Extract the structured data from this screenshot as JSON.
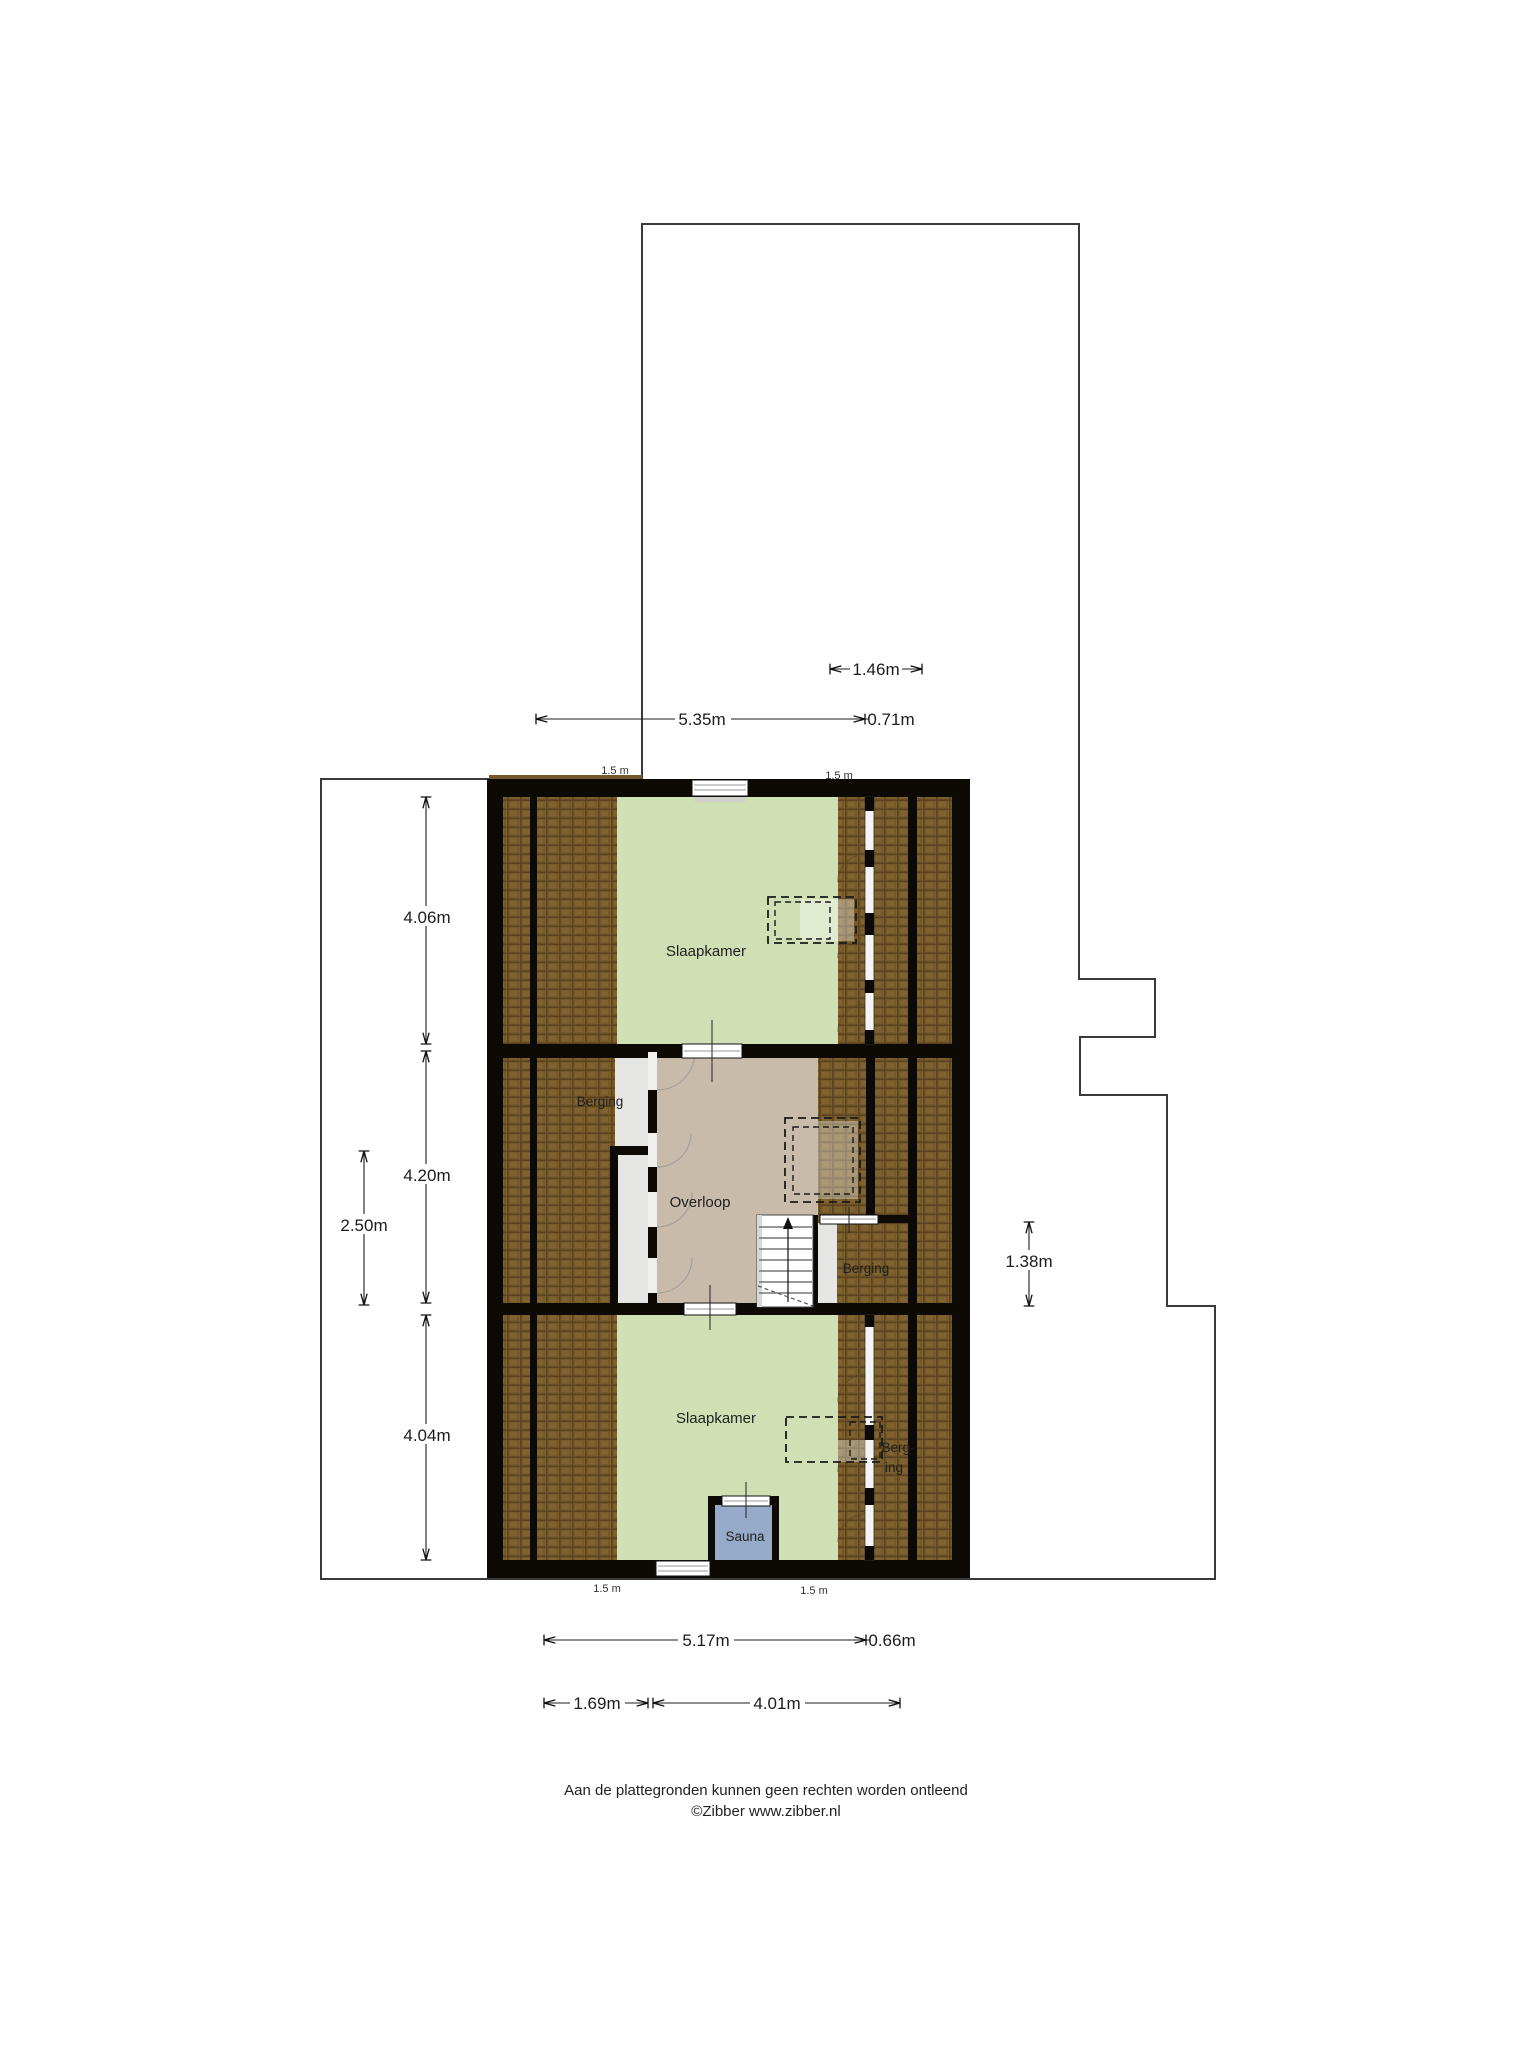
{
  "meta": {
    "type": "floorplan",
    "floor": "attic / second floor"
  },
  "rooms": {
    "slaapkamer_top": {
      "label": "Slaapkamer"
    },
    "berging_left": {
      "label": "Berging"
    },
    "overloop": {
      "label": "Overloop"
    },
    "berging_right": {
      "label": "Berging"
    },
    "slaapkamer_bottom": {
      "label": "Slaapkamer"
    },
    "berging_bottom": {
      "line1": "Berg-",
      "line2": "ing"
    },
    "sauna": {
      "label": "Sauna"
    }
  },
  "dimensions": {
    "top_offset": {
      "label": "1.46m"
    },
    "top_width": {
      "label": "5.35m"
    },
    "top_right": {
      "label": "0.71m"
    },
    "knee_top_left": {
      "label": "1.5 m"
    },
    "knee_top_right": {
      "label": "1.5 m"
    },
    "room_top_height": {
      "label": "4.06m"
    },
    "landing_height": {
      "label": "4.20m"
    },
    "left_width": {
      "label": "2.50m"
    },
    "room_bottom_height": {
      "label": "4.04m"
    },
    "right_height": {
      "label": "1.38m"
    },
    "bottom_width": {
      "label": "5.17m"
    },
    "bottom_right": {
      "label": "0.66m"
    },
    "bottom_seg_left": {
      "label": "1.69m"
    },
    "bottom_seg_mid": {
      "label": "4.01m"
    },
    "knee_bottom_left": {
      "label": "1.5 m"
    },
    "knee_bottom_right": {
      "label": "1.5 m"
    }
  },
  "footer": {
    "disclaimer": "Aan de plattegronden kunnen geen rechten worden ontleend",
    "copyright": "©Zibber www.zibber.nl"
  },
  "colors": {
    "wall": "#0d0a06",
    "roof_tile": "#7d5f2c",
    "roof_tile_dark": "#5a431e",
    "floor_green": "#cfe0b5",
    "floor_tan": "#c9bba9",
    "floor_gray": "#e5e5e3",
    "sauna_blue": "#96abc9",
    "outline": "#3a3a3a"
  }
}
